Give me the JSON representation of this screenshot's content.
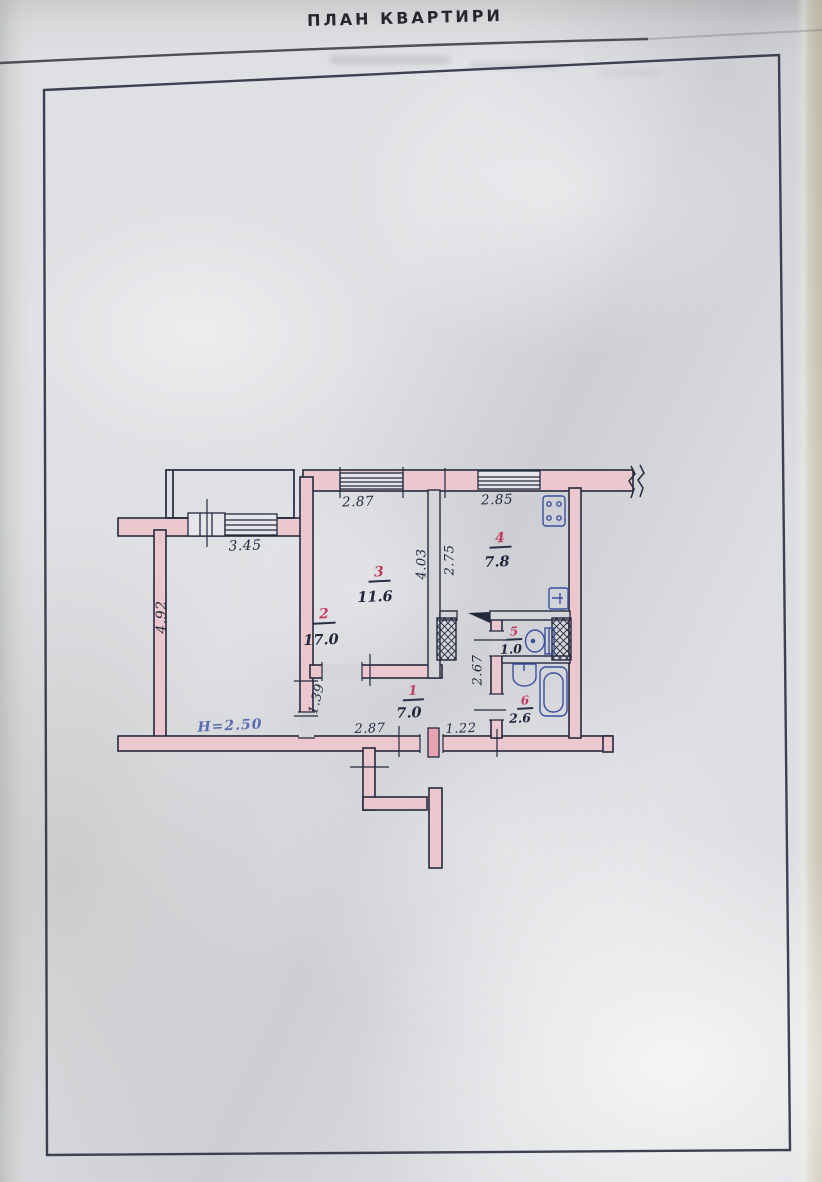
{
  "title": "ПЛАН КВАРТИРИ",
  "document_type": "scanned apartment floor plan",
  "plan": {
    "rooms": [
      {
        "number": "1",
        "area": "7.0",
        "type": "hallway"
      },
      {
        "number": "2",
        "area": "17.0",
        "type": "living-room"
      },
      {
        "number": "3",
        "area": "11.6",
        "type": "room"
      },
      {
        "number": "4",
        "area": "7.8",
        "type": "kitchen"
      },
      {
        "number": "5",
        "area": "1.0",
        "type": "wc"
      },
      {
        "number": "6",
        "area": "2.6",
        "type": "bathroom"
      }
    ],
    "dims": {
      "room2_top": "3.45",
      "room2_left": "4.92",
      "room3_top": "2.87",
      "room3_right": "4.03",
      "room4_top": "2.85",
      "room4_left": "2.75",
      "hall_left": "1.39",
      "hall_bottom_left": "2.87",
      "hall_bottom_right": "1.22",
      "wc_corridor_right": "2.67"
    },
    "ceiling_height": "H=2.50",
    "fixtures": [
      "stove",
      "kitchen-sink",
      "toilet",
      "washbasin",
      "bathtub"
    ],
    "colors": {
      "wall_fill": "#EDC7CE",
      "ink": "#232A3D",
      "room_number_red": "#C23B5F",
      "fixture_blue": "#3A4FA0",
      "height_note_blue": "#5A6CB0",
      "door_leaf_pink": "#E8A2B2",
      "paper": "#D2D3D7"
    }
  }
}
